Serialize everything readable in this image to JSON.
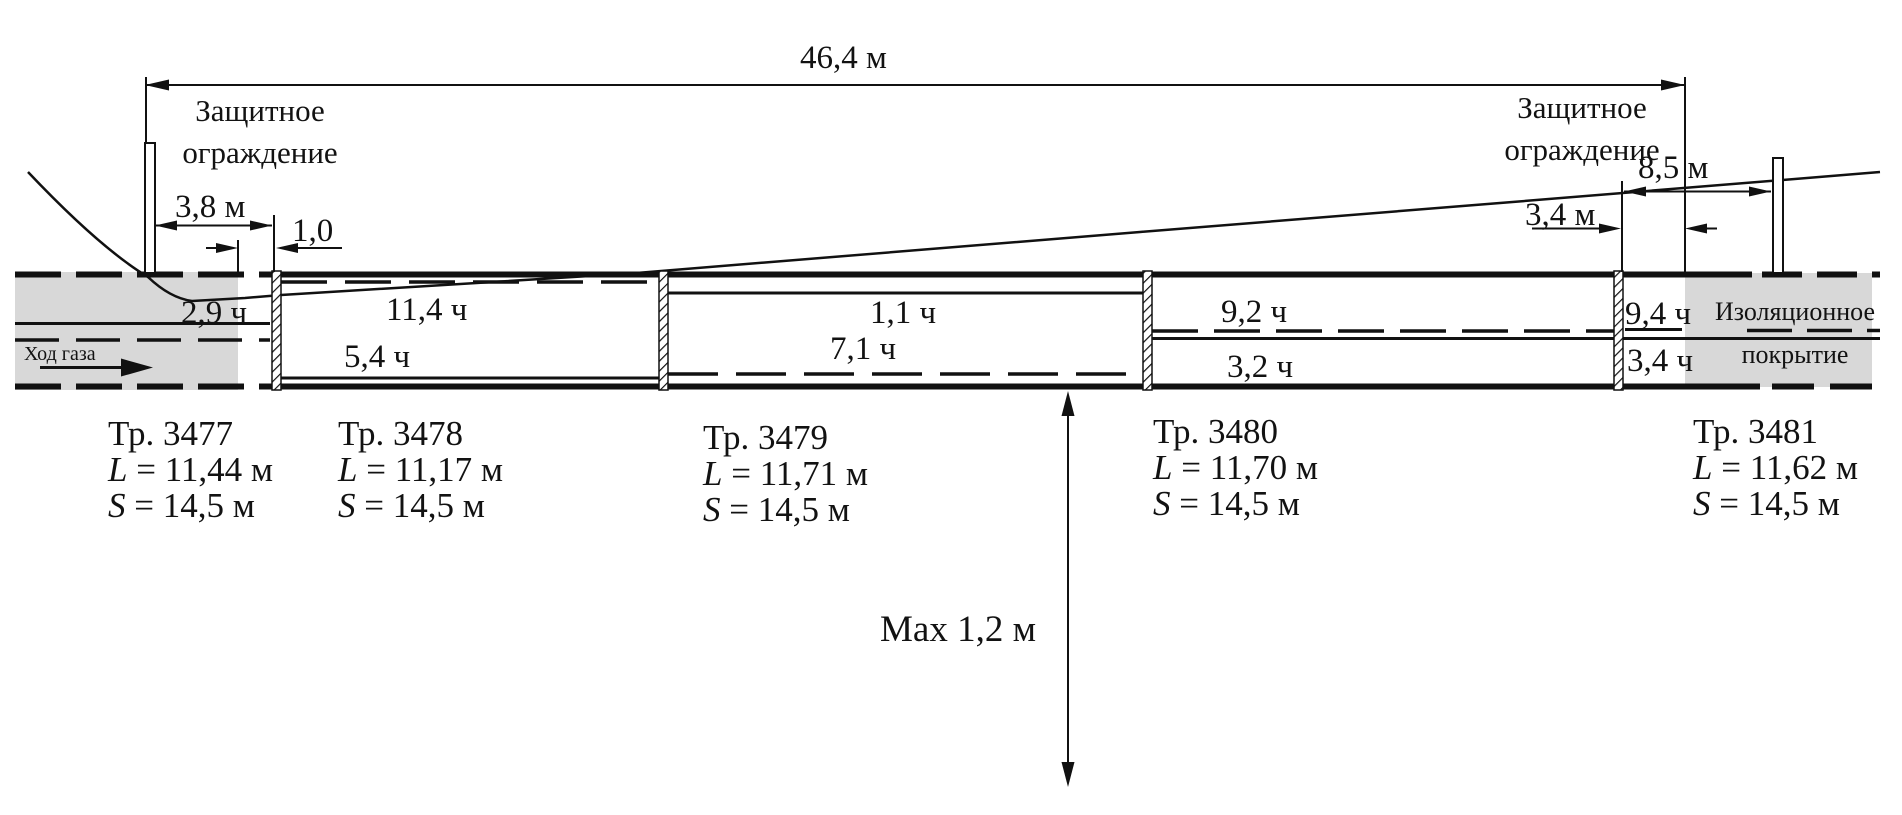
{
  "colors": {
    "soil_gray": "#d8d8d8",
    "line_black": "#111111"
  },
  "dimensions": {
    "overall": "46,4 м",
    "left_fence_offset": "3,8 м",
    "left_gap": "1,0",
    "right_fence_offset": "8,5 м",
    "right_gap": "3,4 м",
    "max_depth": "Max 1,2 м"
  },
  "labels": {
    "fence_left": [
      "Защитное",
      "ограждение"
    ],
    "fence_right": [
      "Защитное",
      "ограждение"
    ],
    "gas_flow": "Ход газа",
    "insulation": [
      "Изоляционное",
      "покрытие"
    ]
  },
  "hour_marks": {
    "s3477": "2,9 ч",
    "s3478_top": "11,4 ч",
    "s3478_bottom": "5,4 ч",
    "s3479_top": "1,1 ч",
    "s3479_bottom": "7,1 ч",
    "s3480_top": "9,2 ч",
    "s3480_bottom": "3,2 ч",
    "s3481_top": "9,4 ч",
    "s3481_bottom": "3,4 ч"
  },
  "pipes": [
    {
      "name": "Тр. 3477",
      "len_var": "L",
      "len_val": " = 11,44 м",
      "span_var": "S",
      "span_val": " = 14,5 м"
    },
    {
      "name": "Тр. 3478",
      "len_var": "L",
      "len_val": " = 11,17 м",
      "span_var": "S",
      "span_val": " = 14,5 м"
    },
    {
      "name": "Тр. 3479",
      "len_var": "L",
      "len_val": " = 11,71 м",
      "span_var": "S",
      "span_val": " = 14,5 м"
    },
    {
      "name": "Тр. 3480",
      "len_var": "L",
      "len_val": " = 11,70 м",
      "span_var": "S",
      "span_val": " = 14,5 м"
    },
    {
      "name": "Тр. 3481",
      "len_var": "L",
      "len_val": " = 11,62 м",
      "span_var": "S",
      "span_val": " = 14,5 м"
    }
  ]
}
